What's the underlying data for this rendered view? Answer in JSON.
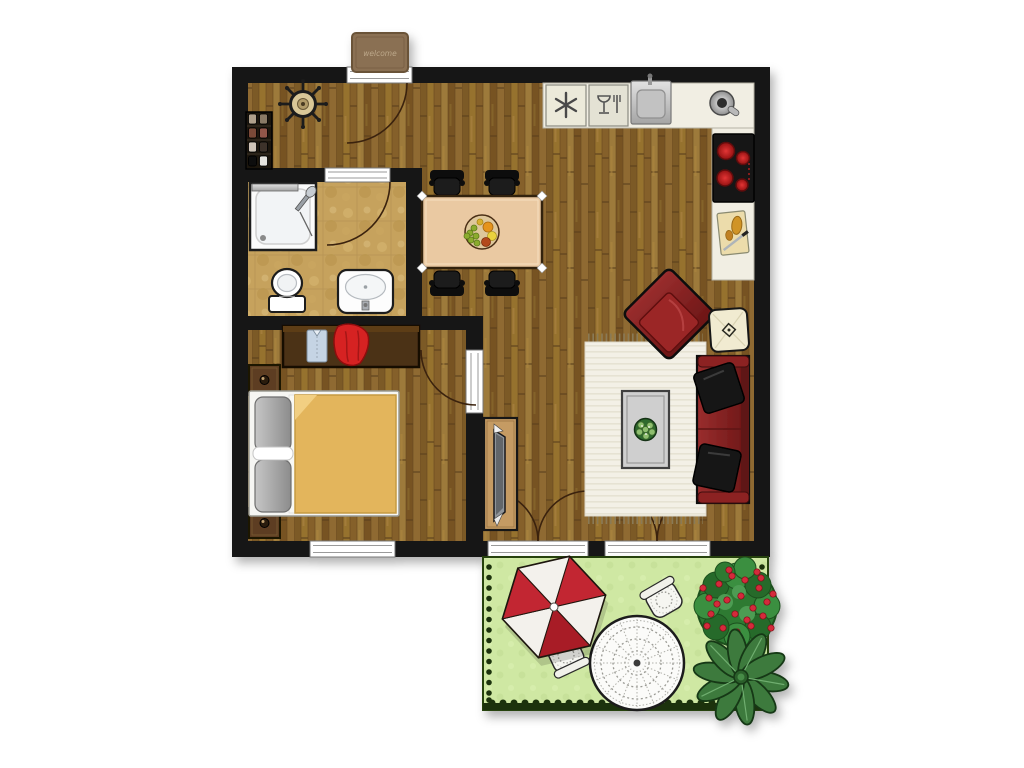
{
  "scene": "apartment-floor-plan-top-view",
  "doormat": {
    "text": "welcome"
  },
  "palette": {
    "wall": "#121212",
    "wood_floor": "#8a6531",
    "bath_floor": "#c6a25d",
    "kitchen_counter": "#f1eee3",
    "dining_table": "#eac9a2",
    "sofa_red": "#7d1d1d",
    "parasol_red": "#c22830",
    "rug_cream": "#f3f0e6",
    "grass_green": "#cfe8a3",
    "hedge_dark_green": "#1e330b",
    "wardrobe_brown": "#4c3013",
    "blanket_gold": "#e3b55c"
  },
  "rooms": {
    "entrance_hall": {
      "items": [
        {
          "name": "entrance-door",
          "count": 1
        },
        {
          "name": "doormat",
          "count": 1
        },
        {
          "name": "coat-rack",
          "count": 1
        },
        {
          "name": "shoe-rack",
          "count": 1
        }
      ]
    },
    "bathroom": {
      "items": [
        {
          "name": "bathroom-door",
          "count": 1
        },
        {
          "name": "shower",
          "count": 1
        },
        {
          "name": "toilet",
          "count": 1
        },
        {
          "name": "washbasin",
          "count": 1
        }
      ]
    },
    "kitchen": {
      "items": [
        {
          "name": "kitchen-counter",
          "count": 2
        },
        {
          "name": "freezer",
          "count": 1
        },
        {
          "name": "dishwasher",
          "count": 1
        },
        {
          "name": "kitchen-sink",
          "count": 1
        },
        {
          "name": "tap",
          "count": 1
        },
        {
          "name": "cooktop",
          "count": 1
        },
        {
          "name": "cutting-board",
          "count": 1
        }
      ]
    },
    "dining_area": {
      "items": [
        {
          "name": "dining-table",
          "count": 1
        },
        {
          "name": "dining-chair",
          "count": 4
        },
        {
          "name": "fruit-bowl",
          "count": 1
        }
      ]
    },
    "living_room": {
      "items": [
        {
          "name": "armchair",
          "count": 1
        },
        {
          "name": "floor-cushion",
          "count": 1
        },
        {
          "name": "sofa",
          "count": 1
        },
        {
          "name": "throw-pillow",
          "count": 2
        },
        {
          "name": "rug",
          "count": 1
        },
        {
          "name": "coffee-table",
          "count": 1
        },
        {
          "name": "potted-plant",
          "count": 1
        },
        {
          "name": "tv-stand",
          "count": 1
        },
        {
          "name": "french-door",
          "count": 2
        }
      ]
    },
    "bedroom": {
      "items": [
        {
          "name": "wardrobe",
          "count": 1
        },
        {
          "name": "double-bed",
          "count": 1
        },
        {
          "name": "nightstand",
          "count": 2
        },
        {
          "name": "bedroom-door",
          "count": 1
        },
        {
          "name": "window",
          "count": 1
        }
      ]
    },
    "terrace": {
      "items": [
        {
          "name": "parasol",
          "count": 1
        },
        {
          "name": "garden-chair",
          "count": 2
        },
        {
          "name": "garden-table",
          "count": 1
        },
        {
          "name": "flowering-shrub",
          "count": 1
        },
        {
          "name": "rosette-plant",
          "count": 1
        }
      ]
    }
  }
}
